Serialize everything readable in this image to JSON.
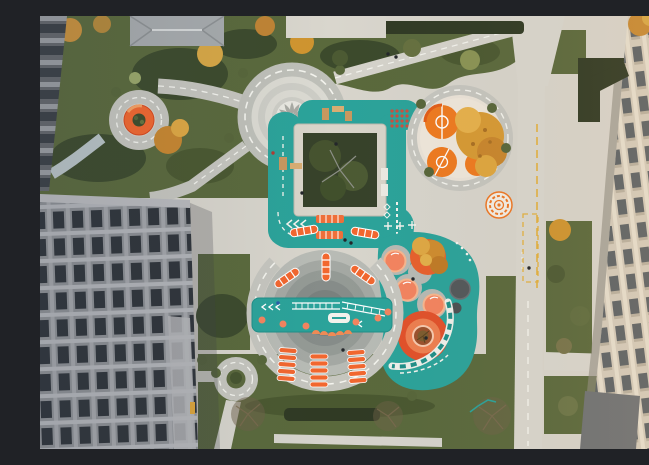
{
  "scene": {
    "type": "aerial-photograph",
    "title": "Aerial drone view of a residential courtyard playground between buildings",
    "description": "Top-down drone photo of a landscaped courtyard: a teal rubber play loop wraps a sunken tree courtyard; a circular paved plaza with pinwheel paving connects by marked paths to an orange ring seat; circular orange play courts sit under autumn trees; a large circular playground holds a teal equipment bridge, orange climbers and striped ladders; teal pad with mushroom seats and an orange target; lawns, hedges, a service road with yellow markings, and office buildings flank left and right."
  },
  "palette": {
    "teal": "#2BA39A",
    "teal_dark": "#1F8F88",
    "orange": "#F2672F",
    "orange_deep": "#E2512A",
    "salmon": "#F4845F",
    "pavement": "#D8D5CC",
    "road_gray": "#C6C6BF",
    "plaza_light": "#DBDAD2",
    "plaza_mid": "#CDCDC6",
    "grass": "#5A693C",
    "grass_dark": "#3C4A2C",
    "hedge": "#303A24",
    "autumn": "#D0952F",
    "autumn_light": "#E3B04A",
    "building_left_wall": "#8C8F93",
    "building_left_window": "#2F343A",
    "building_right_wall": "#D4CCBC",
    "building_right_window": "#5C6367",
    "marking_white": "#F4F4EE",
    "marking_yellow": "#E3B13F",
    "ramp_blue": "#B9C4C6",
    "wood": "#C9985F",
    "dot_red": "#CC4F3D"
  },
  "features": [
    {
      "name": "central-plaza",
      "label": "circular plaza with pinwheel paving and dashed ring road"
    },
    {
      "name": "orange-ring-seat",
      "label": "orange ring seat around planter"
    },
    {
      "name": "tree-courtyard",
      "label": "sunken square courtyard with trees"
    },
    {
      "name": "teal-play-loop",
      "label": "teal rubber loop with game markings and benches"
    },
    {
      "name": "orange-play-courts",
      "label": "circular pad with orange mini courts under autumn tree"
    },
    {
      "name": "target-circle-small",
      "label": "small concentric target marking"
    },
    {
      "name": "big-playground-circle",
      "label": "large circular playground with concentric rings"
    },
    {
      "name": "equipment-bridge",
      "label": "teal play bridge with climbing equipment"
    },
    {
      "name": "striped-ladders",
      "label": "orange striped ladder climbers"
    },
    {
      "name": "mushroom-seats",
      "label": "orange mushroom seats on teal pad"
    },
    {
      "name": "orange-target-large",
      "label": "large orange target with tree"
    },
    {
      "name": "mini-roundabout",
      "label": "small roundabout path with shrub island"
    },
    {
      "name": "service-road",
      "label": "road with yellow fire-lane markings"
    },
    {
      "name": "left-building",
      "label": "gray office building"
    },
    {
      "name": "right-building",
      "label": "beige office building"
    }
  ]
}
